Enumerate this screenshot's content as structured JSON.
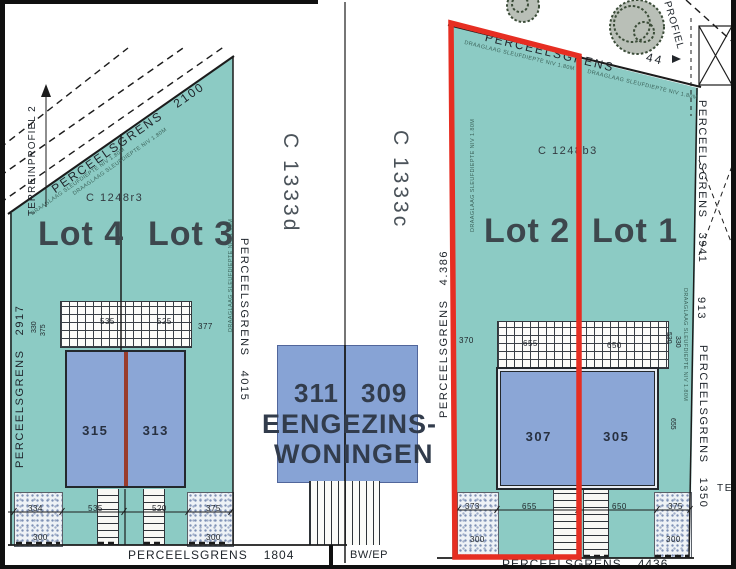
{
  "colors": {
    "teal": "#8ccbc4",
    "building_blue": "#8ba6d6",
    "box_blue": "#87a3d5",
    "highlight_red": "#e62e22",
    "wall_red": "#993c2c",
    "dashed_blue": "#5d6cc0"
  },
  "left_parcel": {
    "terrain_profile": "TERREINPROFIEL 2",
    "top_boundary_label": "PERCEELSGRENS",
    "top_boundary_value": "2100",
    "left_boundary_label": "PERCEELSGRENS",
    "left_boundary_value": "2917",
    "bottom_boundary_label": "PERCEELSGRENS",
    "bottom_boundary_value": "1804",
    "parcel_code": "C 1248r3",
    "lot4_label": "Lot 4",
    "lot3_label": "Lot 3",
    "house_315": "315",
    "house_313": "313",
    "hatch_dim_1": "535",
    "hatch_dim_2": "525",
    "hatch_dim_3": "377",
    "edge_dim_1": "330",
    "edge_dim_2": "375",
    "bottom_dim_1": "334",
    "bottom_dim_2": "535",
    "bottom_dim_3": "520",
    "bottom_dim_4": "375",
    "garden_dim_left": "300",
    "garden_dim_right": "300"
  },
  "middle_strip": {
    "parcel_code_left": "C 1333d",
    "parcel_code_right": "C 1333c",
    "boundary_label": "PERCEELSGRENS",
    "boundary_value": "4015",
    "house_number_left": "311",
    "house_number_right": "309",
    "type_line1": "EENGEZINS-",
    "type_line2": "WONINGEN",
    "bottom_note": "BW/EP"
  },
  "right_parcel": {
    "top_boundary_label": "PERCEELSGRENS",
    "top_boundary_value": "44",
    "profile_label": "PROFIEL",
    "parcel_code": "C 1248b3",
    "lot2_label": "Lot 2",
    "lot1_label": "Lot 1",
    "left_boundary_label": "PERCEELSGRENS",
    "left_boundary_value": "4.386",
    "right_boundary_top_label": "PERCEELSGRENS",
    "right_boundary_top_value": "3941",
    "right_dim": "913",
    "right_boundary_bottom_label": "PERCEELSGRENS",
    "right_boundary_bottom_value": "1350",
    "right_partial_label": "TE",
    "bottom_boundary_label": "PERCEELSGRENS",
    "bottom_boundary_value": "4436",
    "house_307": "307",
    "house_305": "305",
    "hatch_dim_1": "370",
    "hatch_dim_2": "655",
    "hatch_dim_3": "650",
    "edge_dim_1": "530",
    "edge_dim_2": "330",
    "edge_dim_3": "655",
    "bottom_dim_1": "373",
    "bottom_dim_2": "655",
    "bottom_dim_3": "650",
    "bottom_dim_4": "375",
    "garden_dim_left": "300",
    "garden_dim_right": "300"
  },
  "notes": {
    "boundary_note": "DRAAGLAAG SLEUFDIEPTE NIV 1.80M"
  }
}
